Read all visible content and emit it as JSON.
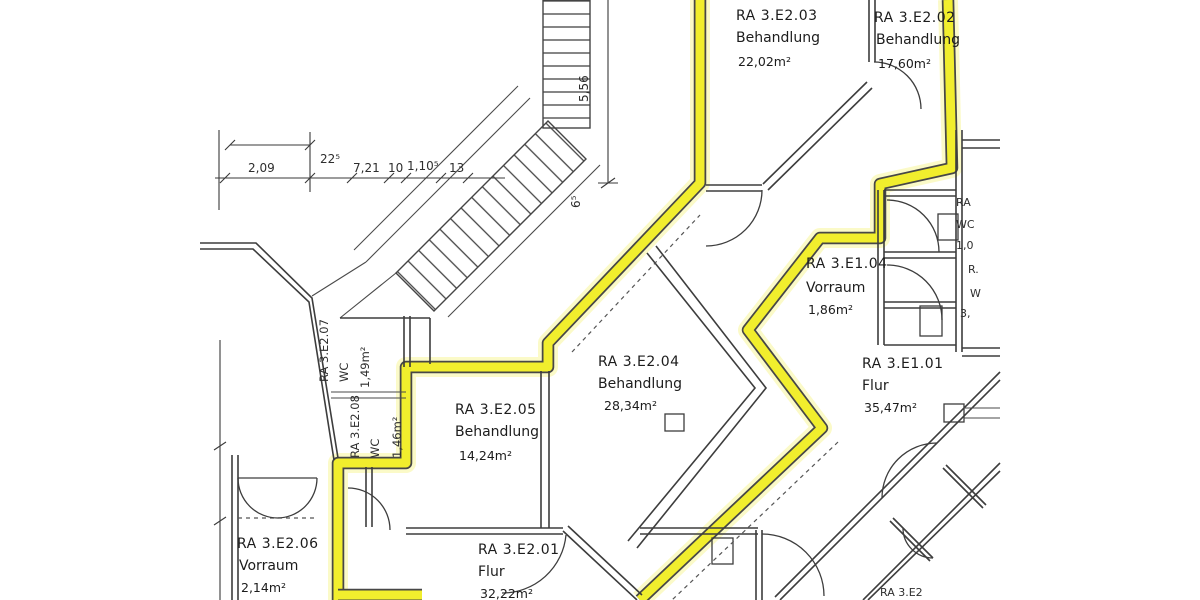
{
  "plan_title": "Grundriss Behandlungsbereich (scan)",
  "rooms": [
    {
      "id": "RA 3.E2.03",
      "type": "Behandlung",
      "area": "22,02m²"
    },
    {
      "id": "RA 3.E2.02",
      "type": "Behandlung",
      "area": "17,60m²"
    },
    {
      "id": "RA 3.E1.04",
      "type": "Vorraum",
      "area": "1,86m²"
    },
    {
      "id": "RA 3.E1.01",
      "type": "Flur",
      "area": "35,47m²"
    },
    {
      "id": "RA 3.E2.04",
      "type": "Behandlung",
      "area": "28,34m²"
    },
    {
      "id": "RA 3.E2.05",
      "type": "Behandlung",
      "area": "14,24m²"
    },
    {
      "id": "RA 3.E2.06",
      "type": "Vorraum",
      "area": "2,14m²"
    },
    {
      "id": "RA 3.E2.01",
      "type": "Flur",
      "area": "32,22m²"
    }
  ],
  "wc_rooms": [
    {
      "id": "RA 3.E2.07",
      "type": "WC",
      "area": "1,49m²"
    },
    {
      "id": "RA 3.E2.08",
      "type": "WC",
      "area": "1,46m²"
    }
  ],
  "dimensions": {
    "horizontal": [
      "2,09",
      "22⁵",
      "7,21",
      "10",
      "1,10⁵",
      "13"
    ],
    "vertical": [
      "5,56",
      "6⁵"
    ]
  },
  "edge_labels": {
    "right": [
      "RA",
      "WC",
      "1,0",
      "R.",
      "W",
      "3,"
    ],
    "bottom": "RA 3.E2"
  },
  "colors": {
    "highlight": "#f1ee2d",
    "halo": "#f8f59b",
    "line": "#3c3c3c"
  }
}
